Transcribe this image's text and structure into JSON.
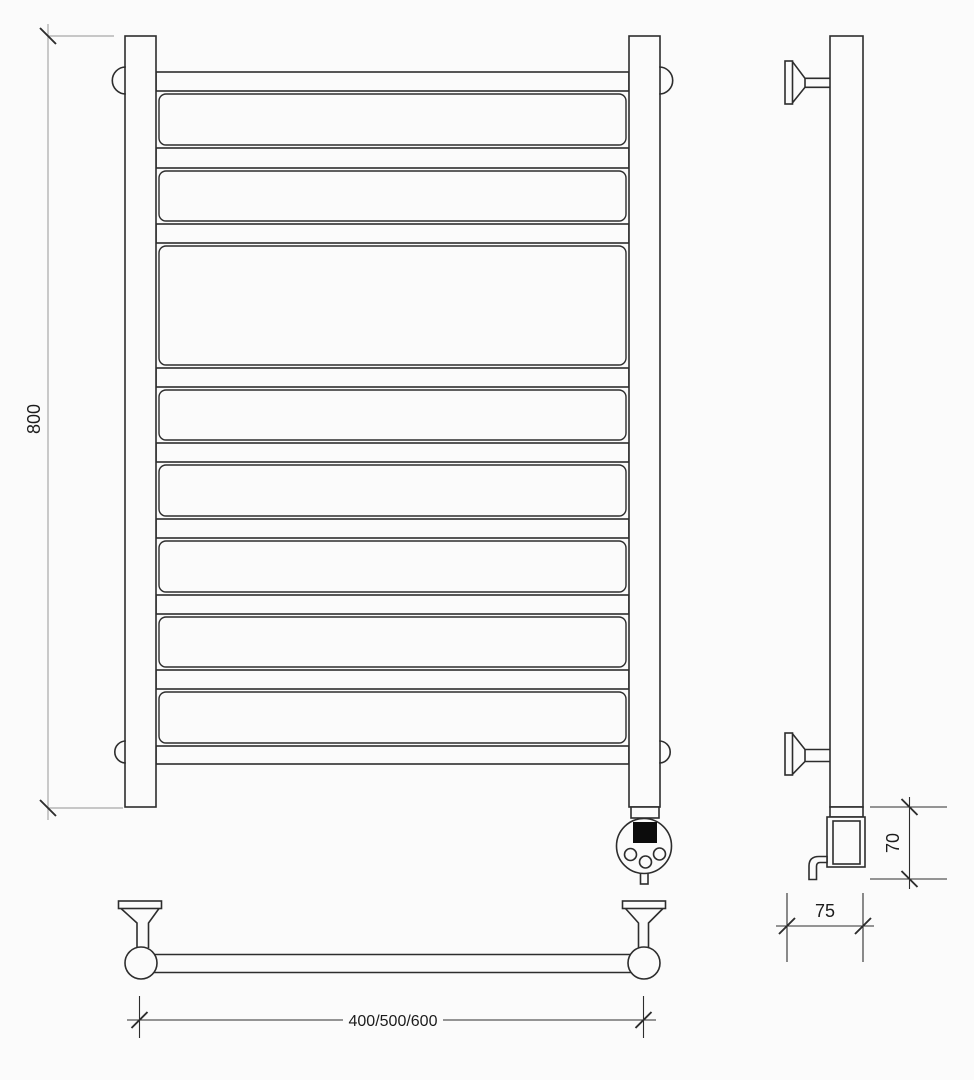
{
  "colors": {
    "paper": "#fbfbfb",
    "line": "#2d2d2d",
    "dim-gray": "#a8a8a8",
    "text": "#1c1c1c",
    "display": "#0c0c0c"
  },
  "dimensions": {
    "height": "800",
    "element_height": "70",
    "wall_depth": "75",
    "width_options": "400/500/600"
  }
}
